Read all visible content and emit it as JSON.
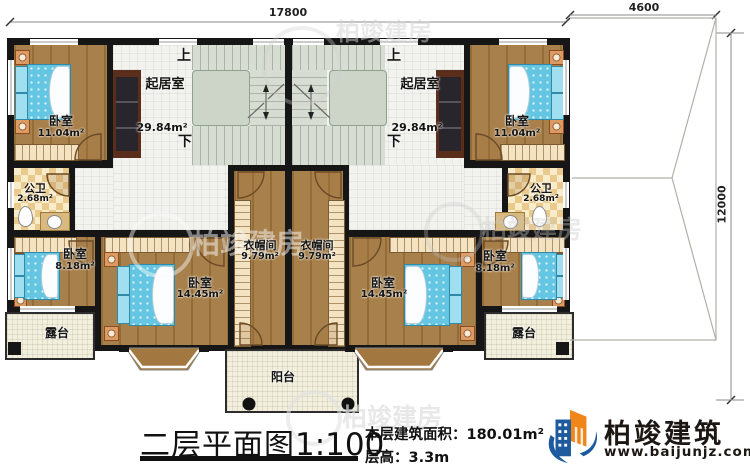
{
  "dimensions": {
    "top": "17800",
    "roof_width": "4600",
    "roof_height": "12000"
  },
  "stairs": {
    "up": "上",
    "down": "下"
  },
  "rooms": {
    "living": {
      "name": "起居室",
      "area": "29.84m²"
    },
    "bedroom_11": {
      "name": "卧室",
      "area": "11.04m²"
    },
    "bedroom_14": {
      "name": "卧室",
      "area": "14.45m²"
    },
    "bedroom_8": {
      "name": "卧室",
      "area": "8.18m²"
    },
    "bath": {
      "name": "公卫",
      "area": "2.68m²"
    },
    "closet": {
      "name": "衣帽间",
      "area": "9.79m²"
    },
    "terrace": {
      "name": "露台"
    },
    "balcony": {
      "name": "阳台"
    }
  },
  "title": {
    "name": "二层平面图",
    "scale": "1:100"
  },
  "info": {
    "area_label": "本层建筑面积：",
    "area_value": "180.01m²",
    "height_label": "层高：",
    "height_value": "3.3m"
  },
  "logo": {
    "brand": "柏竣建筑",
    "url": "www.baijunjz.com",
    "blue": "#1d5a9e",
    "orange": "#f08519"
  },
  "watermark": {
    "text": "柏竣建房"
  }
}
